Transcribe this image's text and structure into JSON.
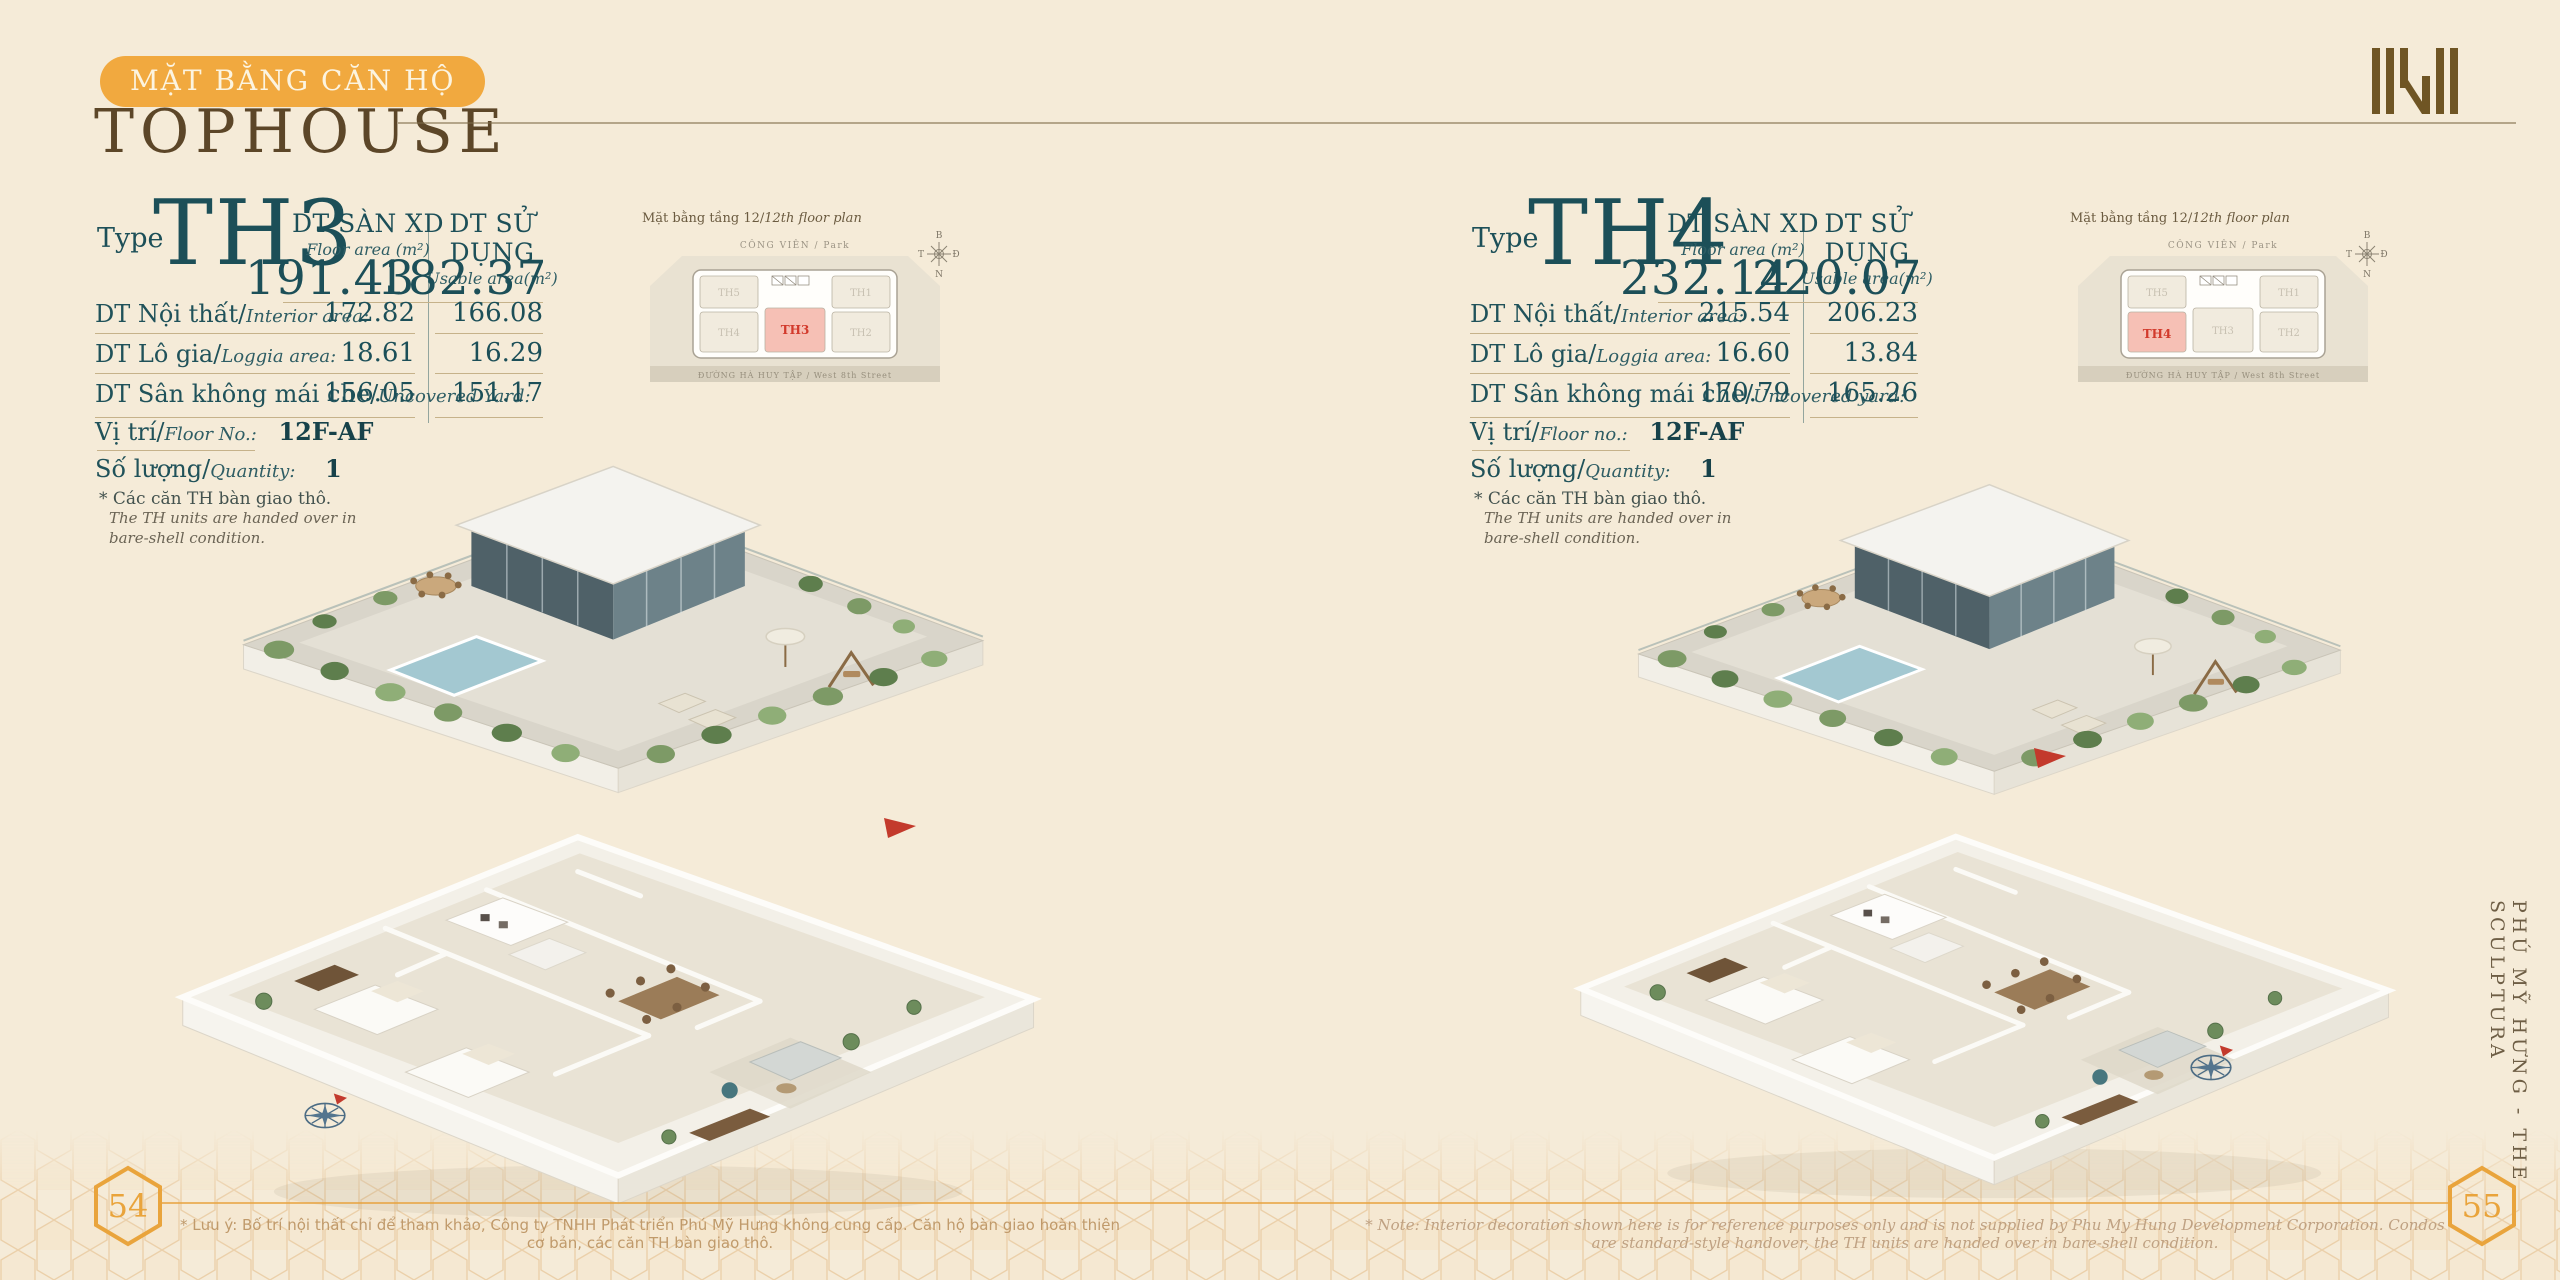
{
  "page": {
    "badge_label": "MẶT BẰNG CĂN HỘ",
    "title": "TOPHOUSE",
    "side_text": "PHÚ MỸ HƯNG - THE SCULPTURA",
    "page_number_left": "54",
    "page_number_right": "55",
    "footnote_left": "* Lưu ý: Bố trí nội thất chỉ để tham khảo, Công ty TNHH Phát triển Phú Mỹ Hưng không cung cấp. Căn hộ bàn giao hoàn thiện cơ bản, các căn TH bàn giao thô.",
    "footnote_right": "* Note: Interior decoration shown here is for reference purposes only and is not supplied by Phu My Hung Development Corporation. Condos are standard-style handover, the TH units are handed over in bare-shell condition.",
    "colors": {
      "accent_orange": "#F1A93F",
      "teal": "#1C4F58",
      "brown": "#5C4628",
      "highlight_pink": "#F6C0B5",
      "highlight_red": "#D23A2C"
    }
  },
  "panels": [
    {
      "type_label": "Type",
      "type_code": "TH3",
      "col1": {
        "title": "DT SÀN XD",
        "subtitle": "Floor area (m²)",
        "total": "191.43"
      },
      "col2": {
        "title": "DT SỬ DỤNG",
        "subtitle": "Usable area(m²)",
        "total": "182.37"
      },
      "rows": [
        {
          "label_vi": "DT Nội thất/",
          "label_en": "Interior area:",
          "v1": "172.82",
          "v2": "166.08"
        },
        {
          "label_vi": "DT Lô gia/",
          "label_en": "Loggia area:",
          "v1": "18.61",
          "v2": "16.29"
        },
        {
          "label_vi": "DT Sân không mái che/",
          "label_en": "Uncovered Yard:",
          "v1": "156.05",
          "v2": "151.17"
        }
      ],
      "floor": {
        "label_vi": "Vị trí/",
        "label_en": "Floor No.:",
        "value": "12F-AF"
      },
      "quantity": {
        "label_vi": "Số lượng/",
        "label_en": "Quantity:",
        "value": "1"
      },
      "note": {
        "vi": "* Các căn TH bàn giao thô.",
        "en1": "The TH units are handed over in",
        "en2": "bare-shell condition."
      },
      "inset": {
        "title_vi": "Mặt bằng tầng 12/",
        "title_en": "12th floor plan",
        "park_label": "CÔNG VIÊN / Park",
        "street_label": "ĐƯỜNG HÀ HUY TẬP / West 8th Street",
        "units": [
          {
            "label": "TH5",
            "fill": "#F1EBDE",
            "color": "#C8C1B2"
          },
          {
            "label": "TH1",
            "fill": "#F1EBDE",
            "color": "#C8C1B2"
          },
          {
            "label": "TH4",
            "fill": "#F1EBDE",
            "color": "#C8C1B2"
          },
          {
            "label": "TH3",
            "fill": "#F6C0B5",
            "color": "#D23A2C"
          },
          {
            "label": "TH2",
            "fill": "#F1EBDE",
            "color": "#C8C1B2"
          }
        ]
      },
      "compass": {
        "n": "B",
        "e": "Đ",
        "s": "N",
        "w": "T"
      }
    },
    {
      "type_label": "Type",
      "type_code": "TH4",
      "col1": {
        "title": "DT SÀN XD",
        "subtitle": "Floor area (m²)",
        "total": "232.14"
      },
      "col2": {
        "title": "DT SỬ DỤNG",
        "subtitle": "Usable area(m²)",
        "total": "220.07"
      },
      "rows": [
        {
          "label_vi": "DT Nội thất/",
          "label_en": "Interior area:",
          "v1": "215.54",
          "v2": "206.23"
        },
        {
          "label_vi": "DT Lô gia/",
          "label_en": "Loggia area:",
          "v1": "16.60",
          "v2": "13.84"
        },
        {
          "label_vi": "DT Sân không mái che/",
          "label_en": "Uncovered yard:",
          "v1": "170.79",
          "v2": "165.26"
        }
      ],
      "floor": {
        "label_vi": "Vị trí/",
        "label_en": "Floor no.:",
        "value": "12F-AF"
      },
      "quantity": {
        "label_vi": "Số lượng/",
        "label_en": "Quantity:",
        "value": "1"
      },
      "note": {
        "vi": "* Các căn TH bàn giao thô.",
        "en1": "The TH units are handed over in",
        "en2": "bare-shell condition."
      },
      "inset": {
        "title_vi": "Mặt bằng tầng 12/",
        "title_en": "12th floor plan",
        "park_label": "CÔNG VIÊN / Park",
        "street_label": "ĐƯỜNG HÀ HUY TẬP / West 8th Street",
        "units": [
          {
            "label": "TH5",
            "fill": "#F1EBDE",
            "color": "#C8C1B2"
          },
          {
            "label": "TH1",
            "fill": "#F1EBDE",
            "color": "#C8C1B2"
          },
          {
            "label": "TH4",
            "fill": "#F6C0B5",
            "color": "#D23A2C"
          },
          {
            "label": "TH3",
            "fill": "#F1EBDE",
            "color": "#C8C1B2"
          },
          {
            "label": "TH2",
            "fill": "#F1EBDE",
            "color": "#C8C1B2"
          }
        ]
      },
      "compass": {
        "n": "B",
        "e": "Đ",
        "s": "N",
        "w": "T"
      }
    }
  ]
}
